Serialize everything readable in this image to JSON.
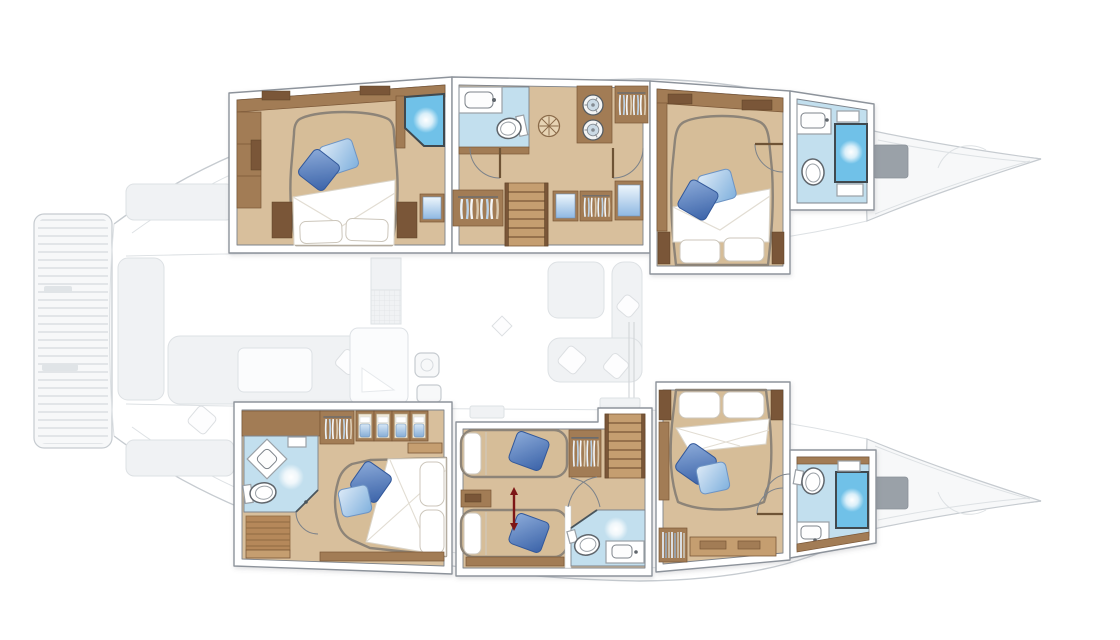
{
  "page": {
    "kind": "yacht-floor-plan-rendering",
    "subject": "catamaran interior deck plan, top-down view, bow to the right",
    "highlight": "lower-deck hull cabins rendered in full color; exterior decks and saloon shown ghosted"
  },
  "colors": {
    "page_bg": "#ffffff",
    "ghost_line": "#c6cbd0",
    "ghost_line_soft": "#dde1e4",
    "ghost_fill": "#f0f2f4",
    "ghost_fill_light": "#f7f8f9",
    "ghost_dark": "#9aa1a8",
    "frame_line": "#8d939b",
    "inner_line": "#7d838b",
    "floor_tan": "#d8bf9c",
    "floor_light": "#e7d4b4",
    "wood_dark": "#7a5737",
    "wood_mid": "#a27c54",
    "wood_light": "#c59e70",
    "bed_tan": "#d6bd98",
    "bed_rim": "#8d8478",
    "bath_floor": "#c2dfee",
    "shower_blue": "#6fc1e8",
    "shower_frame": "#40494f",
    "pillow_dark": "#3f68ae",
    "pillow_light": "#a9cdec",
    "towel_blue": "#86afdc",
    "arrow_red": "#7d1517"
  },
  "deck_ghost_zones": [
    {
      "name": "swim-platform",
      "position": "aft (far left), slatted teak"
    },
    {
      "name": "aft-cockpit",
      "position": "left, sofa, table and seat pads"
    },
    {
      "name": "saloon-galley",
      "position": "center bridge deck, sofa, table, galley island, mast step"
    },
    {
      "name": "foredeck",
      "position": "right, two gray bench seats between bows"
    },
    {
      "name": "bow-peaks",
      "position": "far right, both hull bows tapering to points"
    }
  ],
  "port_hull": {
    "label": "upper hull",
    "rooms": [
      {
        "id": "port-aft-cabin",
        "name": "aft double cabin",
        "furniture": [
          "island double bed",
          "two blue deco pillows",
          "white pillows",
          "wardrobe",
          "corner shower cubicle",
          "side benches",
          "cabinet with blue artwork"
        ]
      },
      {
        "id": "port-bathroom-corridor",
        "name": "bathroom and companionway",
        "furniture": [
          "washbasin counter",
          "toilet",
          "floor hatch",
          "stacked washer-dryer",
          "hanging lockers",
          "companionway stairs",
          "blue-front cabinets"
        ]
      },
      {
        "id": "port-forward-cabin",
        "name": "forward double cabin",
        "furniture": [
          "double bed",
          "two blue deco pillows",
          "white pillows",
          "side benches",
          "overhead lockers"
        ]
      },
      {
        "id": "port-forward-bathroom",
        "name": "forward bathroom",
        "furniture": [
          "washbasin",
          "toilet",
          "shower stall",
          "shelves"
        ]
      }
    ]
  },
  "starboard_hull": {
    "label": "lower hull",
    "rooms": [
      {
        "id": "stbd-aft-cabin",
        "name": "aft double cabin with ensuite",
        "furniture": [
          "double bed",
          "two blue deco pillows",
          "diamond washbasin",
          "toilet",
          "corner shower",
          "teak floor grating",
          "hanging locker",
          "four towel cubbies"
        ]
      },
      {
        "id": "stbd-twin-cabin",
        "name": "twin convertible cabin",
        "furniture": [
          "two single beds",
          "blue deco pillows",
          "sliding conversion arrow",
          "nightstand",
          "hanging locker",
          "companionway stairs",
          "ensuite with toilet, basin and shower"
        ]
      },
      {
        "id": "stbd-forward-cabin",
        "name": "forward double cabin",
        "furniture": [
          "double bed",
          "two blue deco pillows",
          "white pillows",
          "side benches",
          "bookshelf"
        ]
      },
      {
        "id": "stbd-forward-bathroom",
        "name": "forward bathroom",
        "furniture": [
          "washbasin",
          "toilet",
          "shower stall",
          "shelves"
        ]
      }
    ]
  }
}
